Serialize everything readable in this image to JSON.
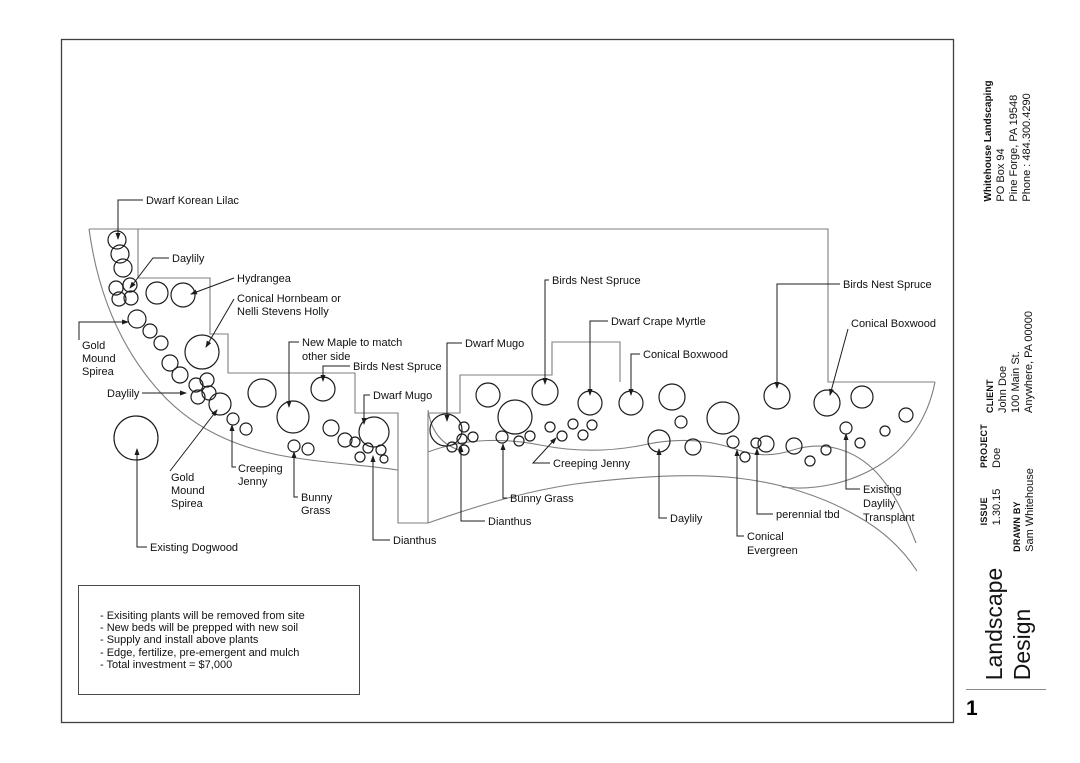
{
  "colors": {
    "outline": "#7f7f7f",
    "ink": "#1c1c1c",
    "border": "#3f3f3f",
    "logo_blue": "#27368f",
    "logo_green": "#2f9e41",
    "logo_green_dark": "#1e7c30"
  },
  "plan": {
    "outlines": [
      "M89,229 L828,229 L828,382 L935,382",
      "M138,229 L138,278 L210,278 L210,334 L228,334 L228,373 L355,373 L355,413 L398,413 L398,523 L428,523 L428,413 L460,413 L460,375 L552,375 L552,342 L620,342 L620,382",
      "M89,229 C98,295 122,350 160,392 C198,434 248,452 303,459 C338,464 372,466 398,470",
      "M428,410 C431,431 441,444 459,450",
      "M428,452 C465,438 505,438 540,445 C575,452 612,452 648,444 C684,437 712,441 735,449 C758,457 775,456 793,450 C825,440 855,450 876,472 C893,490 905,515 916,543",
      "M935,382 C928,418 908,448 878,466 C850,483 815,491 782,487",
      "M428,523 C468,509 520,492 575,484 C630,477 690,473 737,478 C782,483 824,497 857,516 C884,531 904,551 917,571"
    ],
    "circles": [
      [
        117,
        240,
        9
      ],
      [
        120,
        254,
        9
      ],
      [
        123,
        268,
        9
      ],
      [
        116,
        288,
        7
      ],
      [
        130,
        285,
        7
      ],
      [
        119,
        299,
        7
      ],
      [
        131,
        298,
        7
      ],
      [
        157,
        293,
        11
      ],
      [
        183,
        295,
        12
      ],
      [
        137,
        319,
        9
      ],
      [
        150,
        331,
        7
      ],
      [
        161,
        343,
        7
      ],
      [
        202,
        352,
        17
      ],
      [
        170,
        363,
        8
      ],
      [
        180,
        375,
        8
      ],
      [
        196,
        385,
        7
      ],
      [
        207,
        380,
        7
      ],
      [
        198,
        397,
        7
      ],
      [
        209,
        393,
        7
      ],
      [
        220,
        404,
        11
      ],
      [
        233,
        419,
        6
      ],
      [
        246,
        429,
        6
      ],
      [
        262,
        393,
        14
      ],
      [
        293,
        417,
        16
      ],
      [
        323,
        389,
        12
      ],
      [
        294,
        446,
        6
      ],
      [
        308,
        449,
        6
      ],
      [
        331,
        428,
        8
      ],
      [
        345,
        440,
        7
      ],
      [
        355,
        442,
        5
      ],
      [
        368,
        448,
        5
      ],
      [
        360,
        457,
        5
      ],
      [
        381,
        450,
        5
      ],
      [
        384,
        459,
        4
      ],
      [
        374,
        432,
        15
      ],
      [
        136,
        438,
        22
      ],
      [
        446,
        430,
        16
      ],
      [
        464,
        427,
        5
      ],
      [
        462,
        439,
        5
      ],
      [
        473,
        437,
        5
      ],
      [
        452,
        447,
        5
      ],
      [
        464,
        450,
        5
      ],
      [
        488,
        395,
        12
      ],
      [
        515,
        417,
        17
      ],
      [
        545,
        392,
        13
      ],
      [
        502,
        437,
        6
      ],
      [
        519,
        441,
        5
      ],
      [
        530,
        436,
        5
      ],
      [
        550,
        427,
        5
      ],
      [
        562,
        436,
        5
      ],
      [
        573,
        424,
        5
      ],
      [
        583,
        435,
        5
      ],
      [
        592,
        425,
        5
      ],
      [
        590,
        403,
        12
      ],
      [
        631,
        403,
        12
      ],
      [
        659,
        441,
        11
      ],
      [
        672,
        397,
        13
      ],
      [
        681,
        422,
        6
      ],
      [
        693,
        447,
        8
      ],
      [
        723,
        418,
        16
      ],
      [
        733,
        442,
        6
      ],
      [
        745,
        457,
        5
      ],
      [
        756,
        443,
        5
      ],
      [
        766,
        444,
        8
      ],
      [
        777,
        396,
        13
      ],
      [
        794,
        446,
        8
      ],
      [
        810,
        461,
        5
      ],
      [
        826,
        450,
        5
      ],
      [
        827,
        403,
        13
      ],
      [
        846,
        428,
        6
      ],
      [
        862,
        397,
        11
      ],
      [
        860,
        443,
        5
      ],
      [
        885,
        431,
        5
      ],
      [
        906,
        415,
        7
      ]
    ],
    "leaders": [
      "M143,200 L118,200 L118,239",
      "M169,258 L153,258 L130,288",
      "M234,278 L191,294",
      "M234,299 L206,347",
      "M79,340 L79,322 L128,322",
      "M142,393 L186,393",
      "M170,471 L217,410",
      "M147,547 L137,547 L137,449",
      "M236,467 L232,467 L232,425",
      "M298,497 L294,497 L294,452",
      "M390,540 L373,540 L373,456",
      "M299,342 L289,342 L289,407",
      "M350,366 L323,366 L323,381",
      "M370,395 L364,395 L364,424",
      "M462,343 L447,343 L447,421",
      "M549,280 L545,280 L545,384",
      "M608,321 L590,321 L590,395",
      "M640,354 L631,354 L631,395",
      "M840,284 L777,284 L777,388",
      "M848,329 L830,395",
      "M550,463 L533,463 L556,438",
      "M507,498 L503,498 L503,444",
      "M485,521 L461,521 L461,446",
      "M667,518 L659,518 L659,449",
      "M773,514 L757,514 L757,449",
      "M744,536 L737,536 L737,450",
      "M860,489 L846,489 L846,434"
    ],
    "labels": [
      {
        "t": "Dwarf Korean Lilac",
        "x": 146,
        "y": 204
      },
      {
        "t": "Daylily",
        "x": 172,
        "y": 262
      },
      {
        "t": "Hydrangea",
        "x": 237,
        "y": 282
      },
      {
        "t": "Conical Hornbeam or",
        "x": 237,
        "y": 302
      },
      {
        "t": "Nelli Stevens Holly",
        "x": 237,
        "y": 315
      },
      {
        "t": "Gold",
        "x": 82,
        "y": 349
      },
      {
        "t": "Mound",
        "x": 82,
        "y": 362
      },
      {
        "t": "Spirea",
        "x": 82,
        "y": 375
      },
      {
        "t": "Daylily",
        "x": 107,
        "y": 397
      },
      {
        "t": "Gold",
        "x": 171,
        "y": 481
      },
      {
        "t": "Mound",
        "x": 171,
        "y": 494
      },
      {
        "t": "Spirea",
        "x": 171,
        "y": 507
      },
      {
        "t": "Creeping",
        "x": 238,
        "y": 472
      },
      {
        "t": "Jenny",
        "x": 238,
        "y": 485
      },
      {
        "t": "Bunny",
        "x": 301,
        "y": 501
      },
      {
        "t": "Grass",
        "x": 301,
        "y": 514
      },
      {
        "t": "Existing Dogwood",
        "x": 150,
        "y": 551
      },
      {
        "t": "Dianthus",
        "x": 393,
        "y": 544
      },
      {
        "t": "New Maple to match",
        "x": 302,
        "y": 346
      },
      {
        "t": "other side",
        "x": 302,
        "y": 360
      },
      {
        "t": "Birds Nest Spruce",
        "x": 353,
        "y": 370
      },
      {
        "t": "Dwarf Mugo",
        "x": 373,
        "y": 399
      },
      {
        "t": "Dwarf Mugo",
        "x": 465,
        "y": 347
      },
      {
        "t": "Birds Nest Spruce",
        "x": 552,
        "y": 284
      },
      {
        "t": "Dwarf Crape Myrtle",
        "x": 611,
        "y": 325
      },
      {
        "t": "Conical Boxwood",
        "x": 643,
        "y": 358
      },
      {
        "t": "Birds Nest Spruce",
        "x": 843,
        "y": 288
      },
      {
        "t": "Conical Boxwood",
        "x": 851,
        "y": 327
      },
      {
        "t": "Creeping Jenny",
        "x": 553,
        "y": 467
      },
      {
        "t": "Bunny Grass",
        "x": 510,
        "y": 502
      },
      {
        "t": "Dianthus",
        "x": 488,
        "y": 525
      },
      {
        "t": "Daylily",
        "x": 670,
        "y": 522
      },
      {
        "t": "perennial tbd",
        "x": 776,
        "y": 518
      },
      {
        "t": "Conical",
        "x": 747,
        "y": 540
      },
      {
        "t": "Evergreen",
        "x": 747,
        "y": 554
      },
      {
        "t": "Existing",
        "x": 863,
        "y": 493
      },
      {
        "t": "Daylily",
        "x": 863,
        "y": 507
      },
      {
        "t": "Transplant",
        "x": 863,
        "y": 521
      }
    ]
  },
  "notes": {
    "lines": [
      "- Exisiting plants will be removed from site",
      "- New beds will be prepped with new soil",
      "- Supply and install above plants",
      "- Edge, fertilize, pre-emergent and mulch",
      "- Total investment = $7,000"
    ]
  },
  "logo": {
    "brand": "WHITEHOUSE",
    "tagline": "LANDSCAPING"
  },
  "titleblock": {
    "company": {
      "name": "Whitehouse Landscaping",
      "lines": [
        "PO Box 94",
        "Pine Forge, PA 19548",
        "Phone : 484.300.4290"
      ]
    },
    "client": {
      "label": "CLIENT",
      "lines": [
        "John Doe",
        "100 Main St.",
        "Anywhere, PA 00000"
      ]
    },
    "project": {
      "label": "PROJECT",
      "value": "Doe"
    },
    "issue": {
      "label": "ISSUE",
      "value": "1.30.15"
    },
    "drawn_by": {
      "label": "DRAWN BY",
      "value": "Sam Whitehouse"
    },
    "sheet_title": {
      "line1": "Landscape",
      "line2": "Design"
    },
    "page_number": "1"
  }
}
